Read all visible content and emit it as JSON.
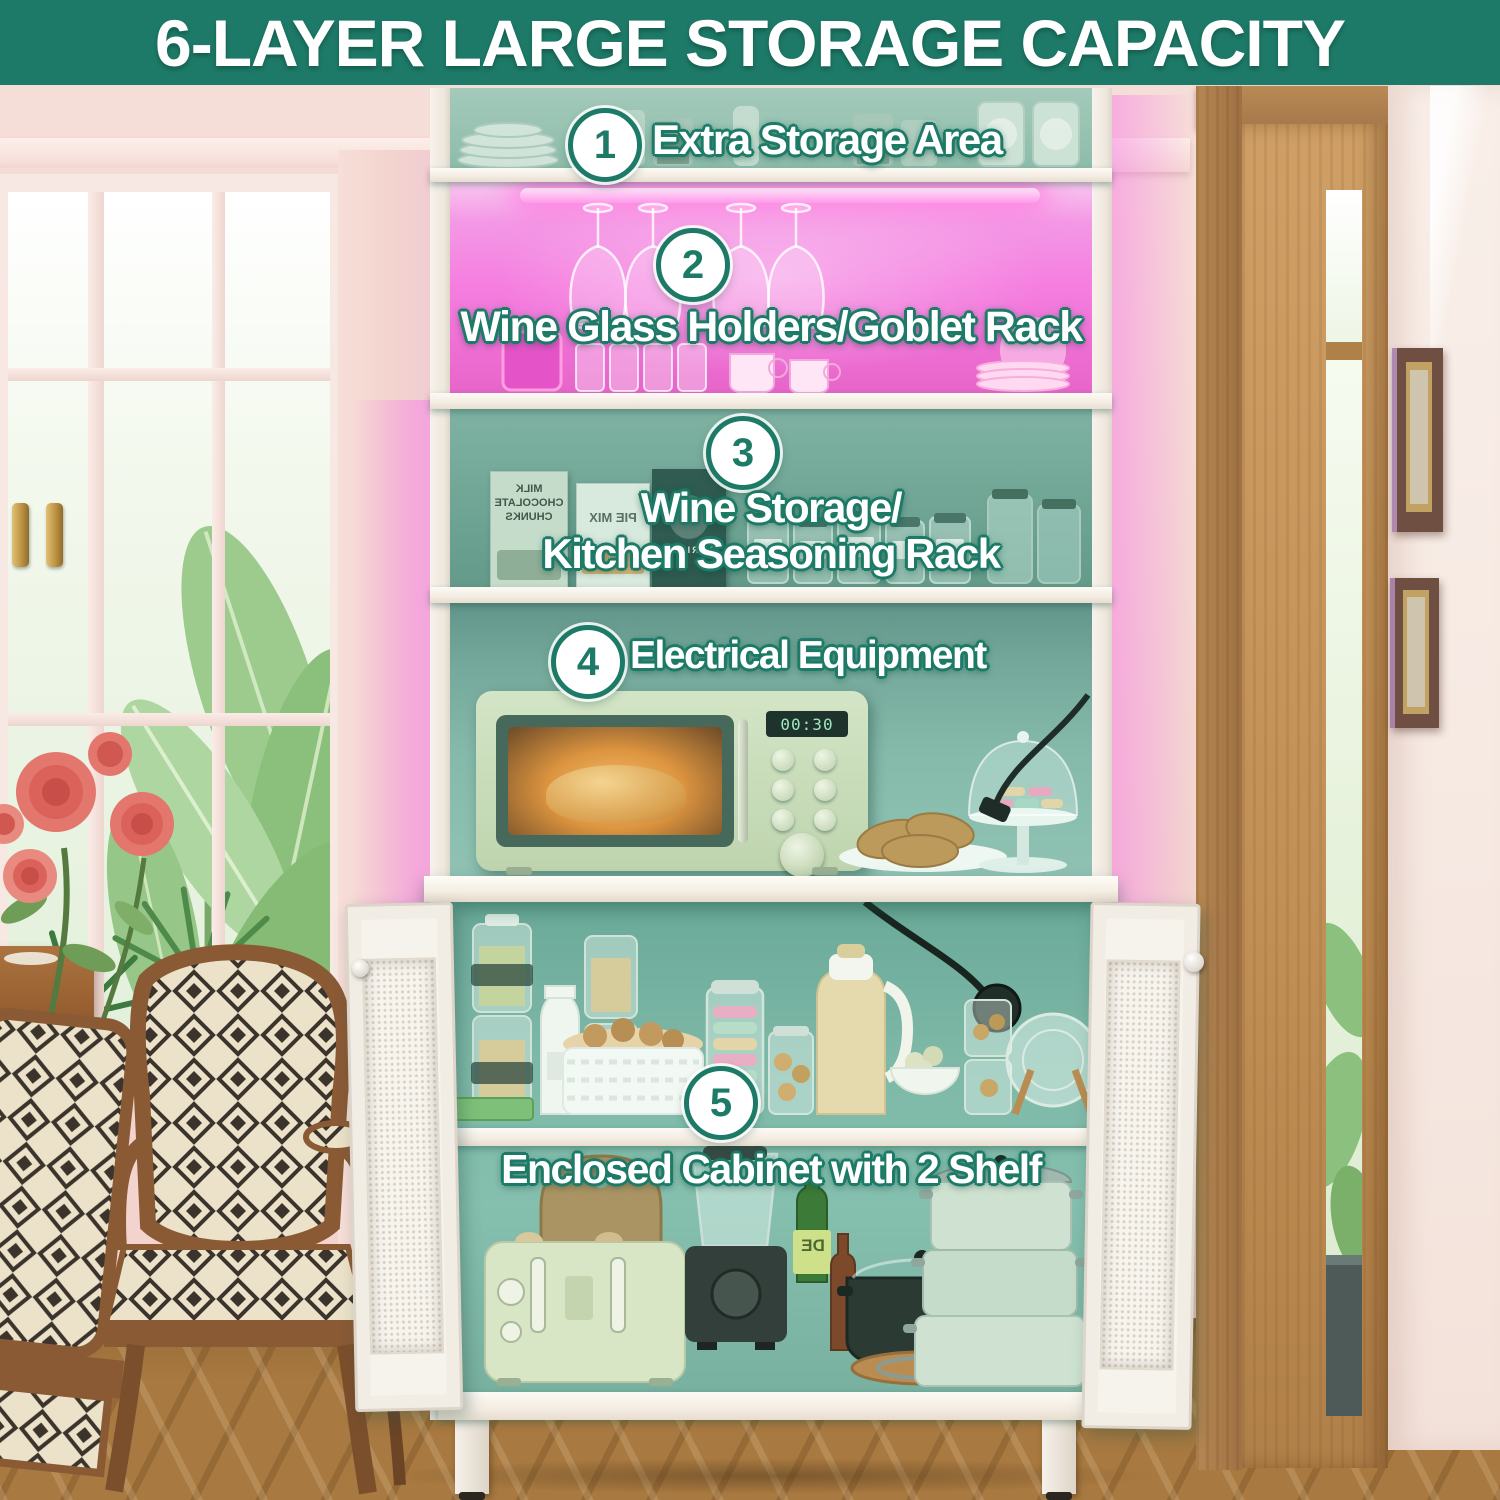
{
  "banner": {
    "title": "6-LAYER LARGE STORAGE CAPACITY"
  },
  "callouts": [
    {
      "number": "1",
      "lines": [
        "Extra Storage Area"
      ]
    },
    {
      "number": "2",
      "lines": [
        "Wine Glass Holders/Goblet Rack"
      ]
    },
    {
      "number": "3",
      "lines": [
        "Wine Storage/",
        "Kitchen Seasoning Rack"
      ]
    },
    {
      "number": "4",
      "lines": [
        "Electrical Equipment"
      ]
    },
    {
      "number": "5",
      "lines": [
        "Enclosed Cabinet with 2 Shelf"
      ]
    }
  ],
  "microwave": {
    "display": "00:30"
  },
  "packages": {
    "box1": [
      "MILK",
      "CHOCOLATE",
      "CHUNKS"
    ],
    "box2": "PIE MIX",
    "box3": "BARISTA",
    "bottle_label": "DE"
  },
  "colors": {
    "banner_bg": "#1E7A68",
    "badge_teal": "#1C7A67",
    "callout_outline": "#1C7A67",
    "led_pink": "#FF7CE0",
    "cabinet_overlay_teal": "#2E8F7C",
    "door_wood": "#C99C64"
  }
}
